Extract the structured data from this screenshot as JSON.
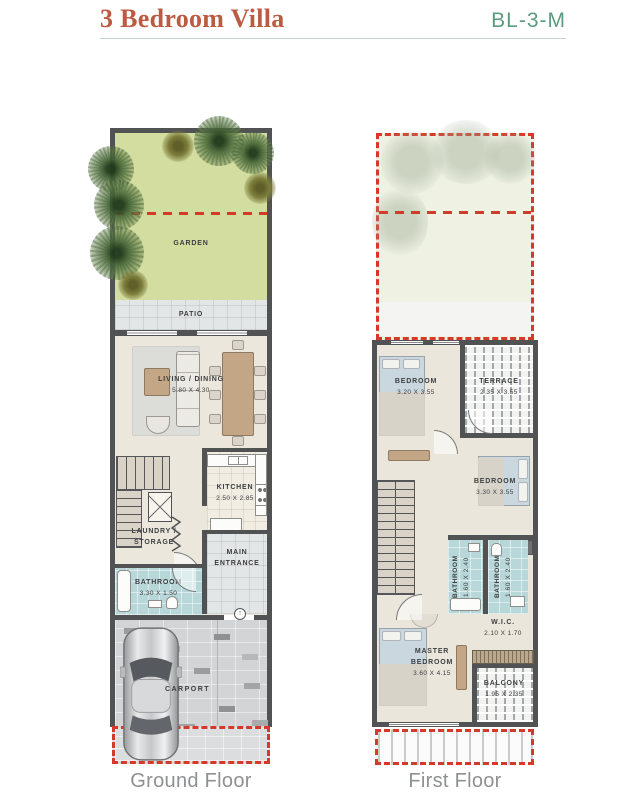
{
  "header": {
    "title": "3 Bedroom Villa",
    "code": "BL-3-M"
  },
  "ground_floor": {
    "label": "Ground Floor",
    "rooms": {
      "garden": {
        "name": "GARDEN"
      },
      "patio": {
        "name": "PATIO"
      },
      "living_dining": {
        "name": "LIVING / DINING",
        "dims": "5.80 X 4.30"
      },
      "kitchen": {
        "name": "KITCHEN",
        "dims": "2.50 X 2.85"
      },
      "laundry_storage": {
        "line1": "LAUNDRY /",
        "line2": "STORAGE"
      },
      "main_entrance": {
        "line1": "MAIN",
        "line2": "ENTRANCE"
      },
      "bathroom": {
        "name": "BATHROOM",
        "dims": "3.30 X 1.50"
      },
      "carport": {
        "name": "CARPORT"
      }
    }
  },
  "first_floor": {
    "label": "First Floor",
    "rooms": {
      "bedroom_1": {
        "name": "BEDROOM",
        "dims": "3.20 X 3.55"
      },
      "terrace": {
        "name": "TERRACE",
        "dims": "2.35 X 3.55"
      },
      "bedroom_2": {
        "name": "BEDROOM",
        "dims": "3.30 X 3.55"
      },
      "bathroom_1": {
        "name": "BATHROOM",
        "dims": "1.60 X 2.40"
      },
      "bathroom_2": {
        "name": "BATHROOM",
        "dims": "1.60 X 2.40"
      },
      "wic": {
        "name": "W.I.C.",
        "dims": "2.10 X 1.70"
      },
      "master_bedroom": {
        "line1": "MASTER",
        "line2": "BEDROOM",
        "dims": "3.60 X 4.15"
      },
      "balcony": {
        "name": "BALCONY",
        "dims": "1.95 X 2.35"
      }
    }
  },
  "colors": {
    "title_red": "#bc5b41",
    "code_green": "#5a9c7d",
    "boundary_dash_red": "#d4392a",
    "wall_gray": "#515254",
    "garden_green": "#d3dd9f",
    "bathroom_teal": "#b7d7d8"
  }
}
